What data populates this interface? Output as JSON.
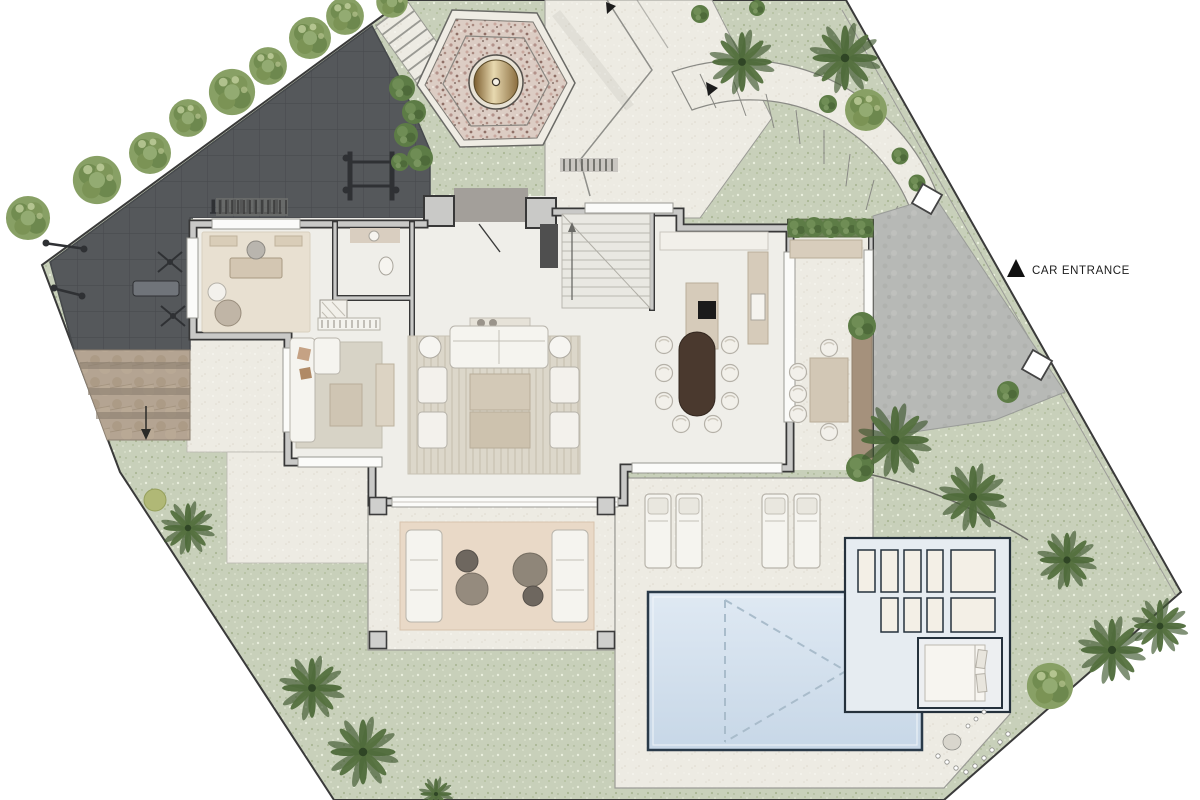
{
  "annotations": {
    "car_entrance": "CAR ENTRANCE"
  },
  "icons": {
    "car_entrance_marker": "filled-triangle-icon",
    "path_direction_arrow": "small-triangle-icon",
    "steps_direction_arrow": "down-arrow-icon"
  },
  "colors": {
    "lawn": "#c8d0ba",
    "hardscape_cream": "#edebe3",
    "gym_terrace_dark": "#55585b",
    "driveway": "#b7b9b6",
    "flagstone": "#b4a492",
    "pool_water": "#cfdeed",
    "pool_edge": "#2a3a49",
    "wall_fill": "#c9c9c7",
    "wall_edge": "#383838",
    "travertine": "#d6cbba",
    "dining_table_wood": "#4a392e",
    "outdoor_rug": "#e9d9c7",
    "hedge_green": "#4e6e3c",
    "palm_green": "#4f6b3b",
    "fountain_pebble": "#dccdc4",
    "fountain_brass": "#8a6a35",
    "label_text": "#1c1c1c"
  }
}
